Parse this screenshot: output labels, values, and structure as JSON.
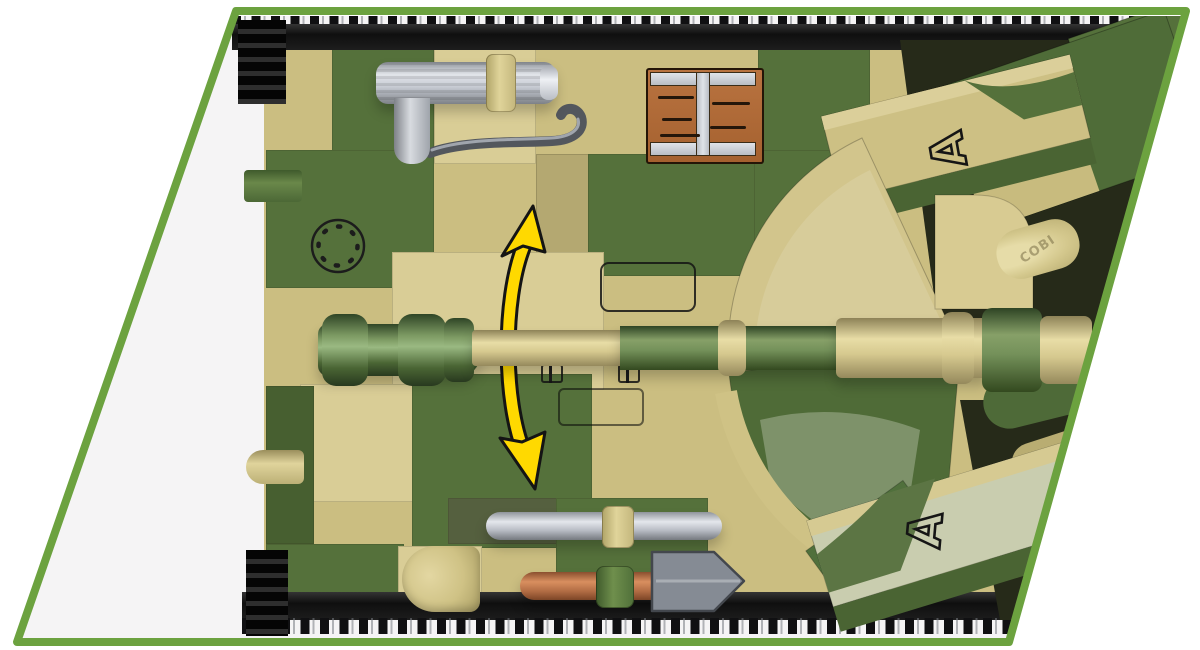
{
  "markings": {
    "turret_top_letter": "A",
    "turret_bottom_letter": "A",
    "brand_emboss": "COBI"
  },
  "colors": {
    "bg": "#ffffff",
    "inner": "#f5f4f5",
    "frame": "#6ca23f",
    "tan": "#cbbe81",
    "tanLight": "#d9cd96",
    "tanDark": "#b4a871",
    "green": "#55713b",
    "greenDark": "#475f30",
    "greenPale": "#a3b28f",
    "track": "#161616",
    "steel": "#c3c7cf",
    "steelDark": "#5f646b",
    "copper": "#b5724a",
    "crate": "#b26d3b",
    "crateEdge": "#241507",
    "metal": "#ccd0d6",
    "arrowYellow": "#ffd900",
    "ink": "#161616",
    "darkZone": "#2b2f1e"
  }
}
